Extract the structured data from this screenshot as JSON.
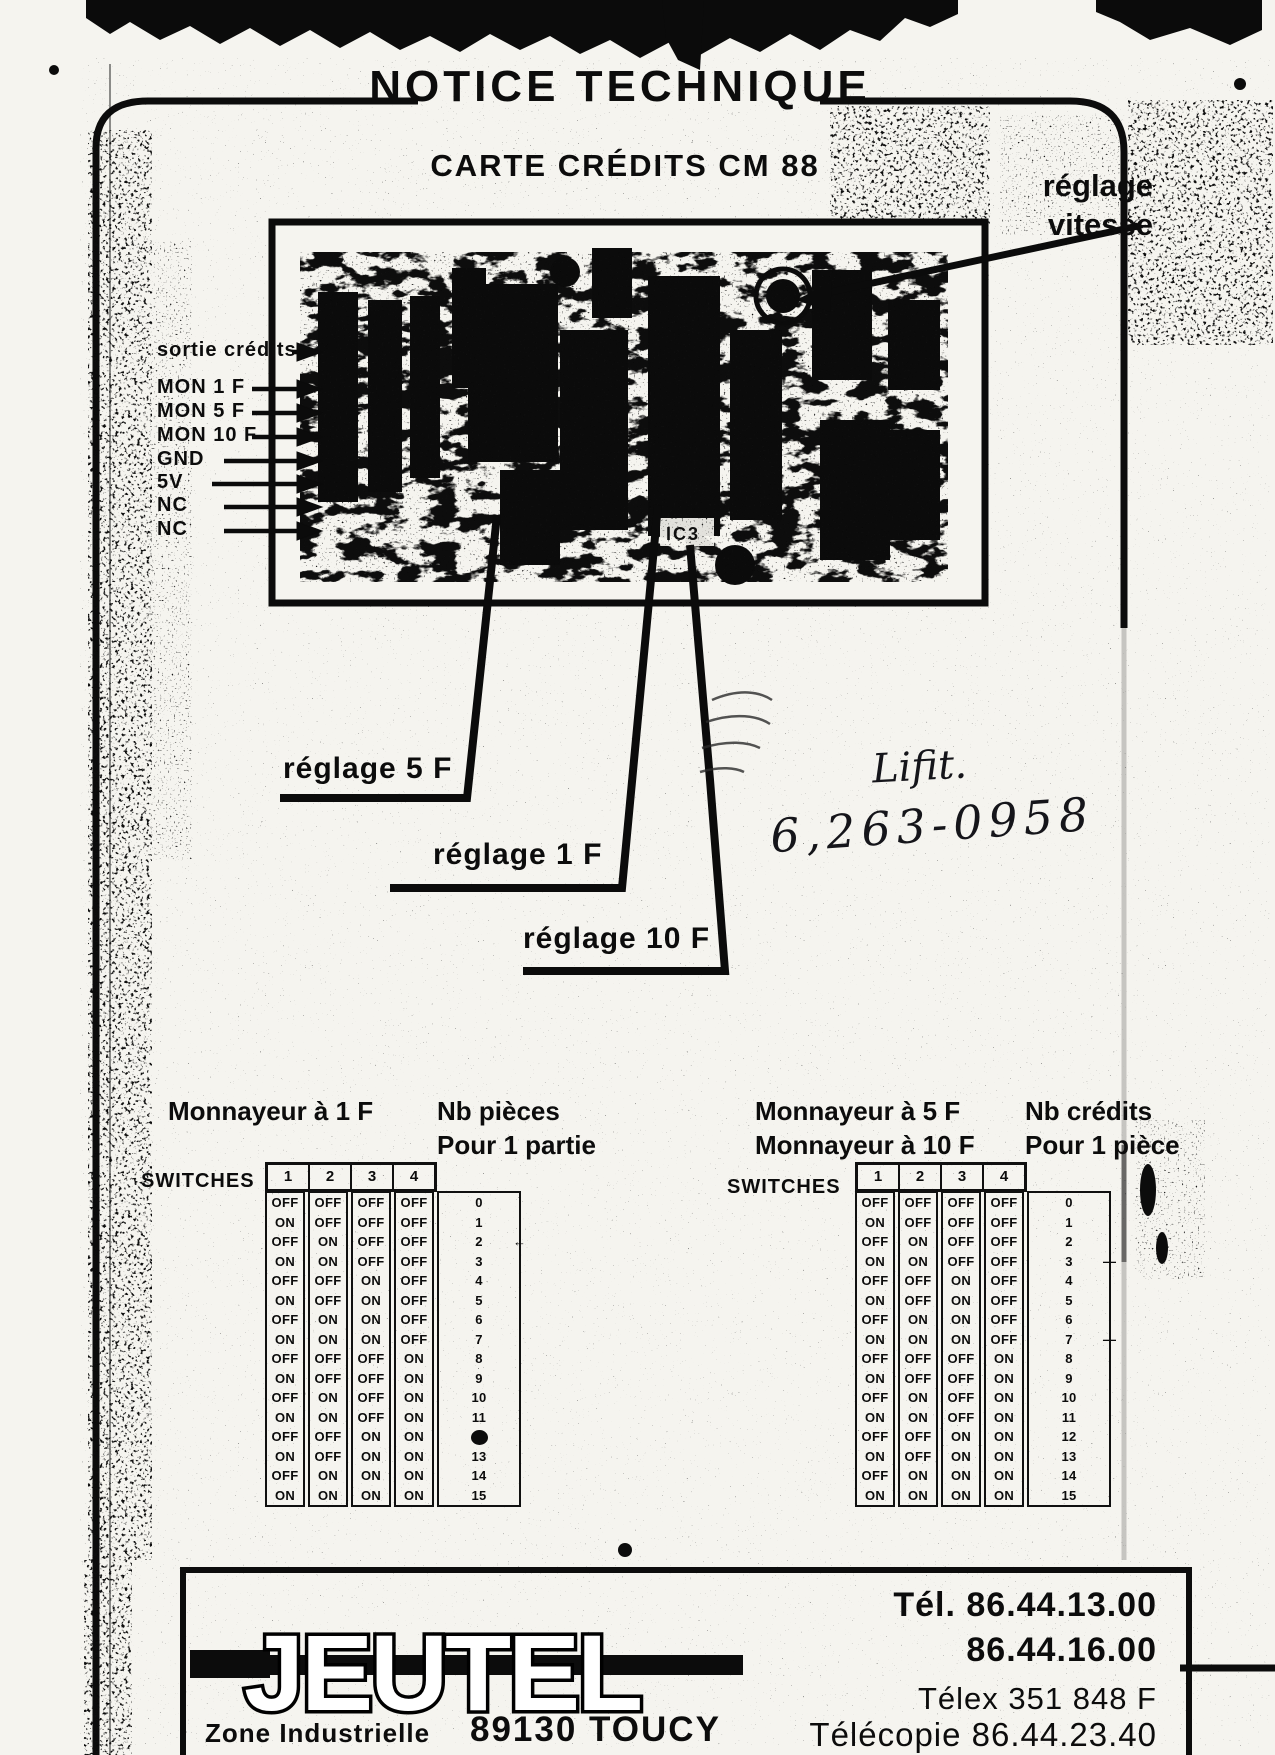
{
  "colors": {
    "ink": "#0c0c0c",
    "paper": "#f5f4ef"
  },
  "document": {
    "title": "NOTICE TECHNIQUE",
    "subtitle": "CARTE CRÉDITS  CM 88"
  },
  "board": {
    "reglage_vitesse_lines": [
      "réglage",
      "vitesse"
    ],
    "connector_labels": [
      "sortie crédits",
      "MON 1 F",
      "MON 5 F",
      "MON 10 F",
      "GND",
      "5V",
      "NC",
      "NC"
    ],
    "callout_5f": "réglage 5 F",
    "callout_1f": "réglage 1 F",
    "callout_10f": "réglage 10 F",
    "ic_label": "IC3"
  },
  "handwriting": {
    "note": "Lifit.",
    "number": "6,263-0958"
  },
  "switch_section": {
    "left_table": {
      "coin_lines": [
        "Monnayeur à 1 F"
      ],
      "result_lines": [
        "Nb pièces",
        "Pour 1 partie"
      ],
      "switches_label": "SWITCHES",
      "columns": [
        "1",
        "2",
        "3",
        "4"
      ],
      "marks": [
        {
          "row": 2,
          "type": "arrow"
        },
        {
          "row": 12,
          "type": "blob"
        }
      ]
    },
    "right_table": {
      "coin_lines": [
        "Monnayeur à 5 F",
        "Monnayeur à 10 F"
      ],
      "result_lines": [
        "Nb crédits",
        "Pour 1 pièce"
      ],
      "switches_label": "SWITCHES",
      "columns": [
        "1",
        "2",
        "3",
        "4"
      ],
      "marks": [
        {
          "row": 3,
          "type": "dash"
        },
        {
          "row": 7,
          "type": "dash"
        }
      ]
    },
    "rows": [
      {
        "switches": [
          "OFF",
          "OFF",
          "OFF",
          "OFF"
        ],
        "value": "0"
      },
      {
        "switches": [
          "ON",
          "OFF",
          "OFF",
          "OFF"
        ],
        "value": "1"
      },
      {
        "switches": [
          "OFF",
          "ON",
          "OFF",
          "OFF"
        ],
        "value": "2"
      },
      {
        "switches": [
          "ON",
          "ON",
          "OFF",
          "OFF"
        ],
        "value": "3"
      },
      {
        "switches": [
          "OFF",
          "OFF",
          "ON",
          "OFF"
        ],
        "value": "4"
      },
      {
        "switches": [
          "ON",
          "OFF",
          "ON",
          "OFF"
        ],
        "value": "5"
      },
      {
        "switches": [
          "OFF",
          "ON",
          "ON",
          "OFF"
        ],
        "value": "6"
      },
      {
        "switches": [
          "ON",
          "ON",
          "ON",
          "OFF"
        ],
        "value": "7"
      },
      {
        "switches": [
          "OFF",
          "OFF",
          "OFF",
          "ON"
        ],
        "value": "8"
      },
      {
        "switches": [
          "ON",
          "OFF",
          "OFF",
          "ON"
        ],
        "value": "9"
      },
      {
        "switches": [
          "OFF",
          "ON",
          "OFF",
          "ON"
        ],
        "value": "10"
      },
      {
        "switches": [
          "ON",
          "ON",
          "OFF",
          "ON"
        ],
        "value": "11"
      },
      {
        "switches": [
          "OFF",
          "OFF",
          "ON",
          "ON"
        ],
        "value": "12"
      },
      {
        "switches": [
          "ON",
          "OFF",
          "ON",
          "ON"
        ],
        "value": "13"
      },
      {
        "switches": [
          "OFF",
          "ON",
          "ON",
          "ON"
        ],
        "value": "14"
      },
      {
        "switches": [
          "ON",
          "ON",
          "ON",
          "ON"
        ],
        "value": "15"
      }
    ]
  },
  "footer": {
    "logo": "JEUTEL",
    "address_line1": "Zone Industrielle",
    "address_line2": "89130 TOUCY",
    "phone1": "Tél. 86.44.13.00",
    "phone2": "86.44.16.00",
    "telex": "Télex 351 848 F",
    "fax": "Télécopie 86.44.23.40"
  }
}
